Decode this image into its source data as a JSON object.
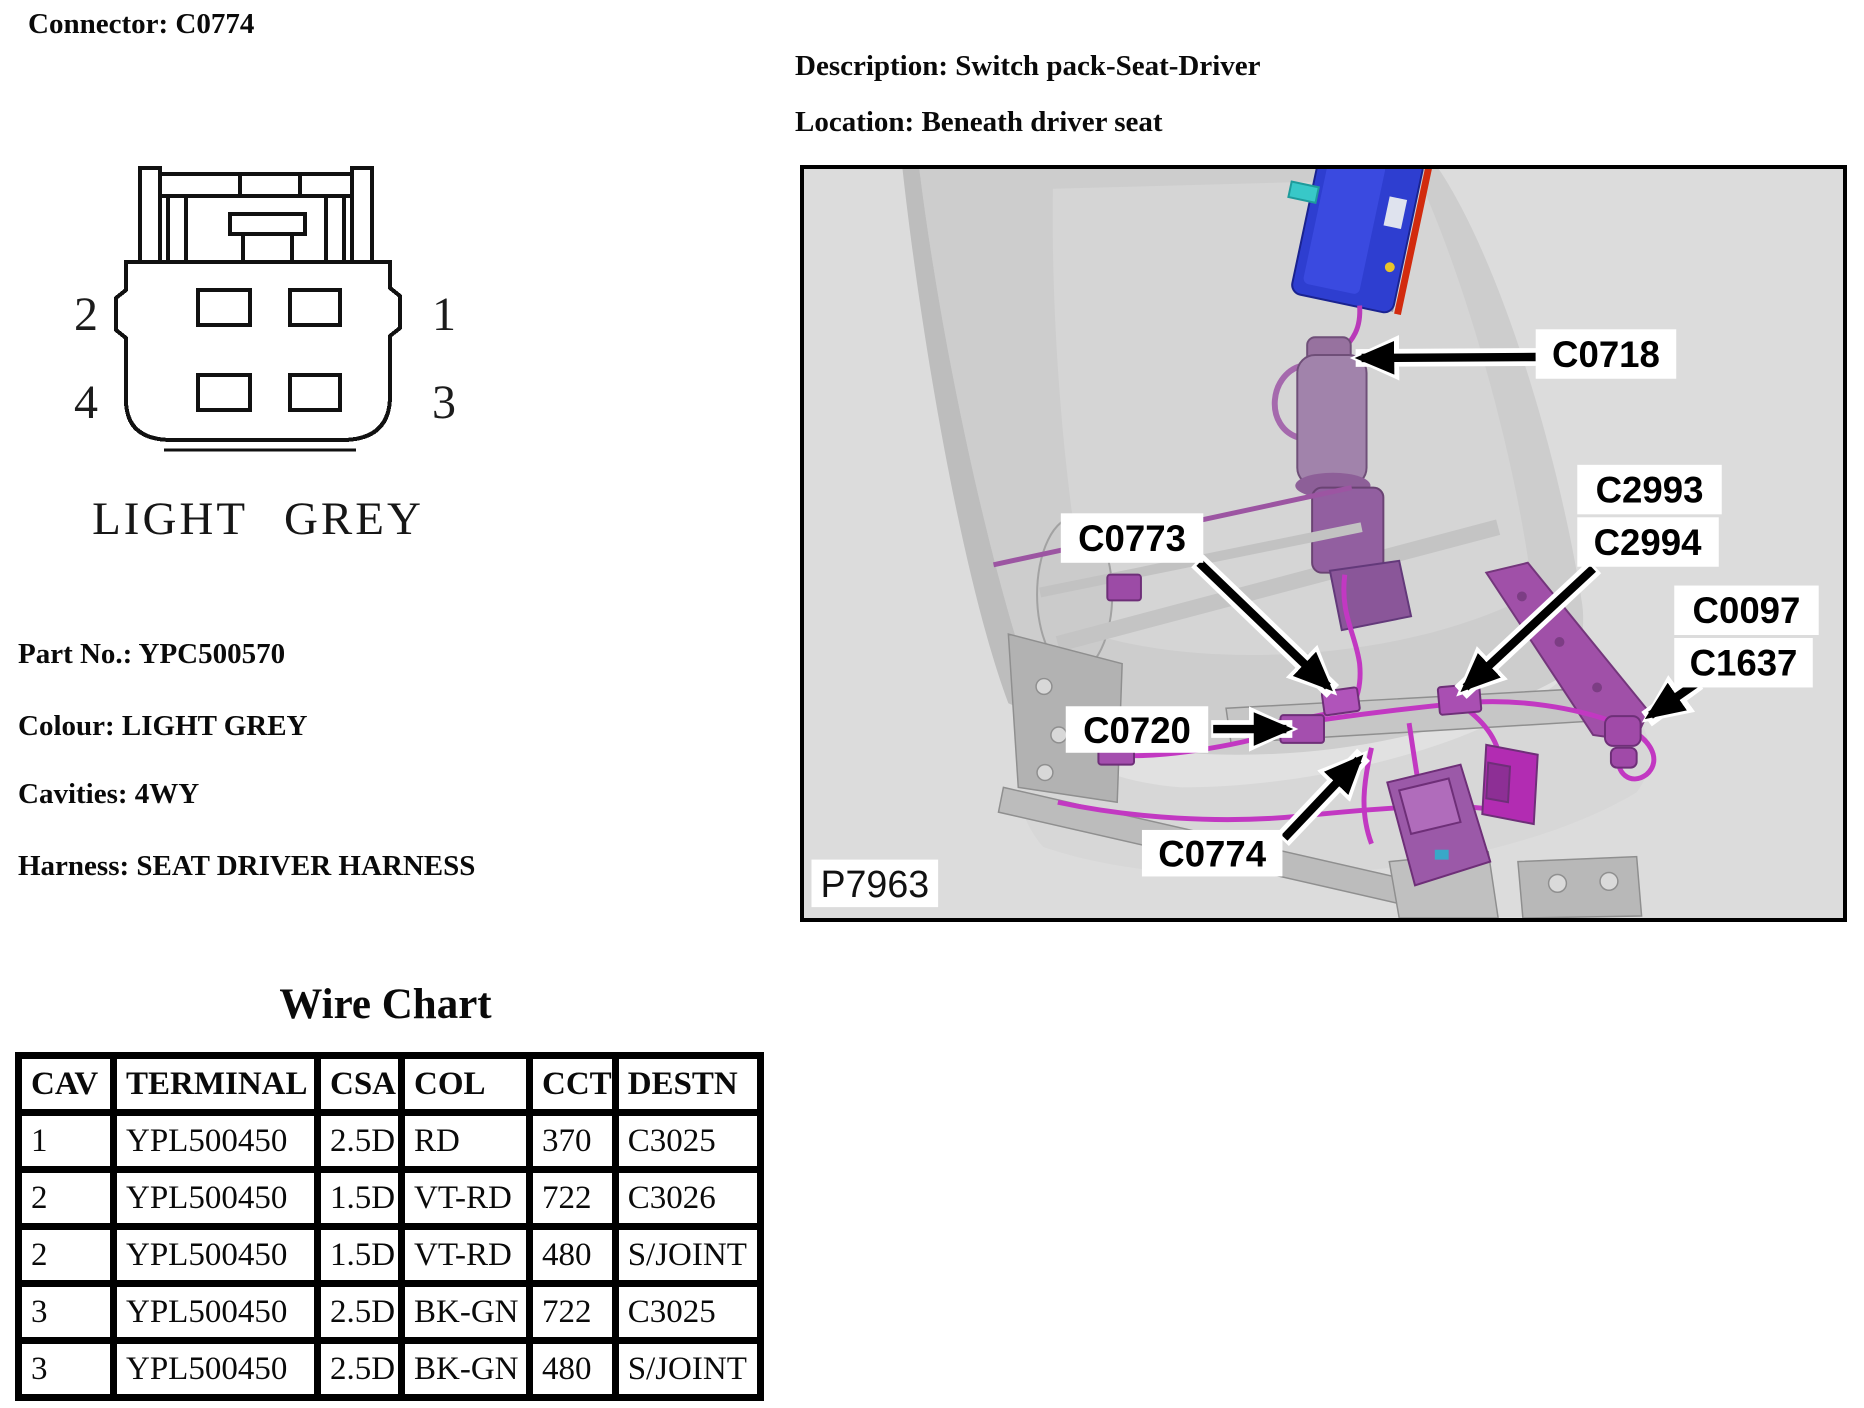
{
  "doc": {
    "connector_title": "Connector: C0774",
    "description": "Description: Switch pack-Seat-Driver",
    "location": "Location: Beneath driver seat",
    "part_no": "Part No.: YPC500570",
    "colour": "Colour: LIGHT GREY",
    "cavities": "Cavities: 4WY",
    "harness": "Harness: SEAT DRIVER HARNESS"
  },
  "connector_diagram": {
    "colour_caption": "LIGHT GREY",
    "pins": {
      "top_left": "2",
      "top_right": "1",
      "bottom_left": "4",
      "bottom_right": "3"
    }
  },
  "figure": {
    "figure_ref": "P7963",
    "callouts": {
      "c0718": "C0718",
      "c2993": "C2993",
      "c2994": "C2994",
      "c0097": "C0097",
      "c1637": "C1637",
      "c0773": "C0773",
      "c0720": "C0720",
      "c0774": "C0774"
    },
    "colors": {
      "background": "#dcdcdc",
      "seat_grey": "#cdcdcd",
      "frame_grey": "#b5b5b5",
      "harness_magenta": "#c238c2",
      "connector_purple": "#a04aa8",
      "module_blue": "#2e3ed0",
      "module_red_stripe": "#d22b0e",
      "module_cyan": "#38c8c8"
    }
  },
  "wire_chart": {
    "title": "Wire Chart",
    "columns": [
      "CAV",
      "TERMINAL",
      "CSA",
      "COL",
      "CCT",
      "DESTN"
    ],
    "rows": [
      [
        "1",
        "YPL500450",
        "2.5D",
        "RD",
        "370",
        "C3025"
      ],
      [
        "2",
        "YPL500450",
        "1.5D",
        "VT-RD",
        "722",
        "C3026"
      ],
      [
        "2",
        "YPL500450",
        "1.5D",
        "VT-RD",
        "480",
        "S/JOINT"
      ],
      [
        "3",
        "YPL500450",
        "2.5D",
        "BK-GN",
        "722",
        "C3025"
      ],
      [
        "3",
        "YPL500450",
        "2.5D",
        "BK-GN",
        "480",
        "S/JOINT"
      ]
    ]
  }
}
